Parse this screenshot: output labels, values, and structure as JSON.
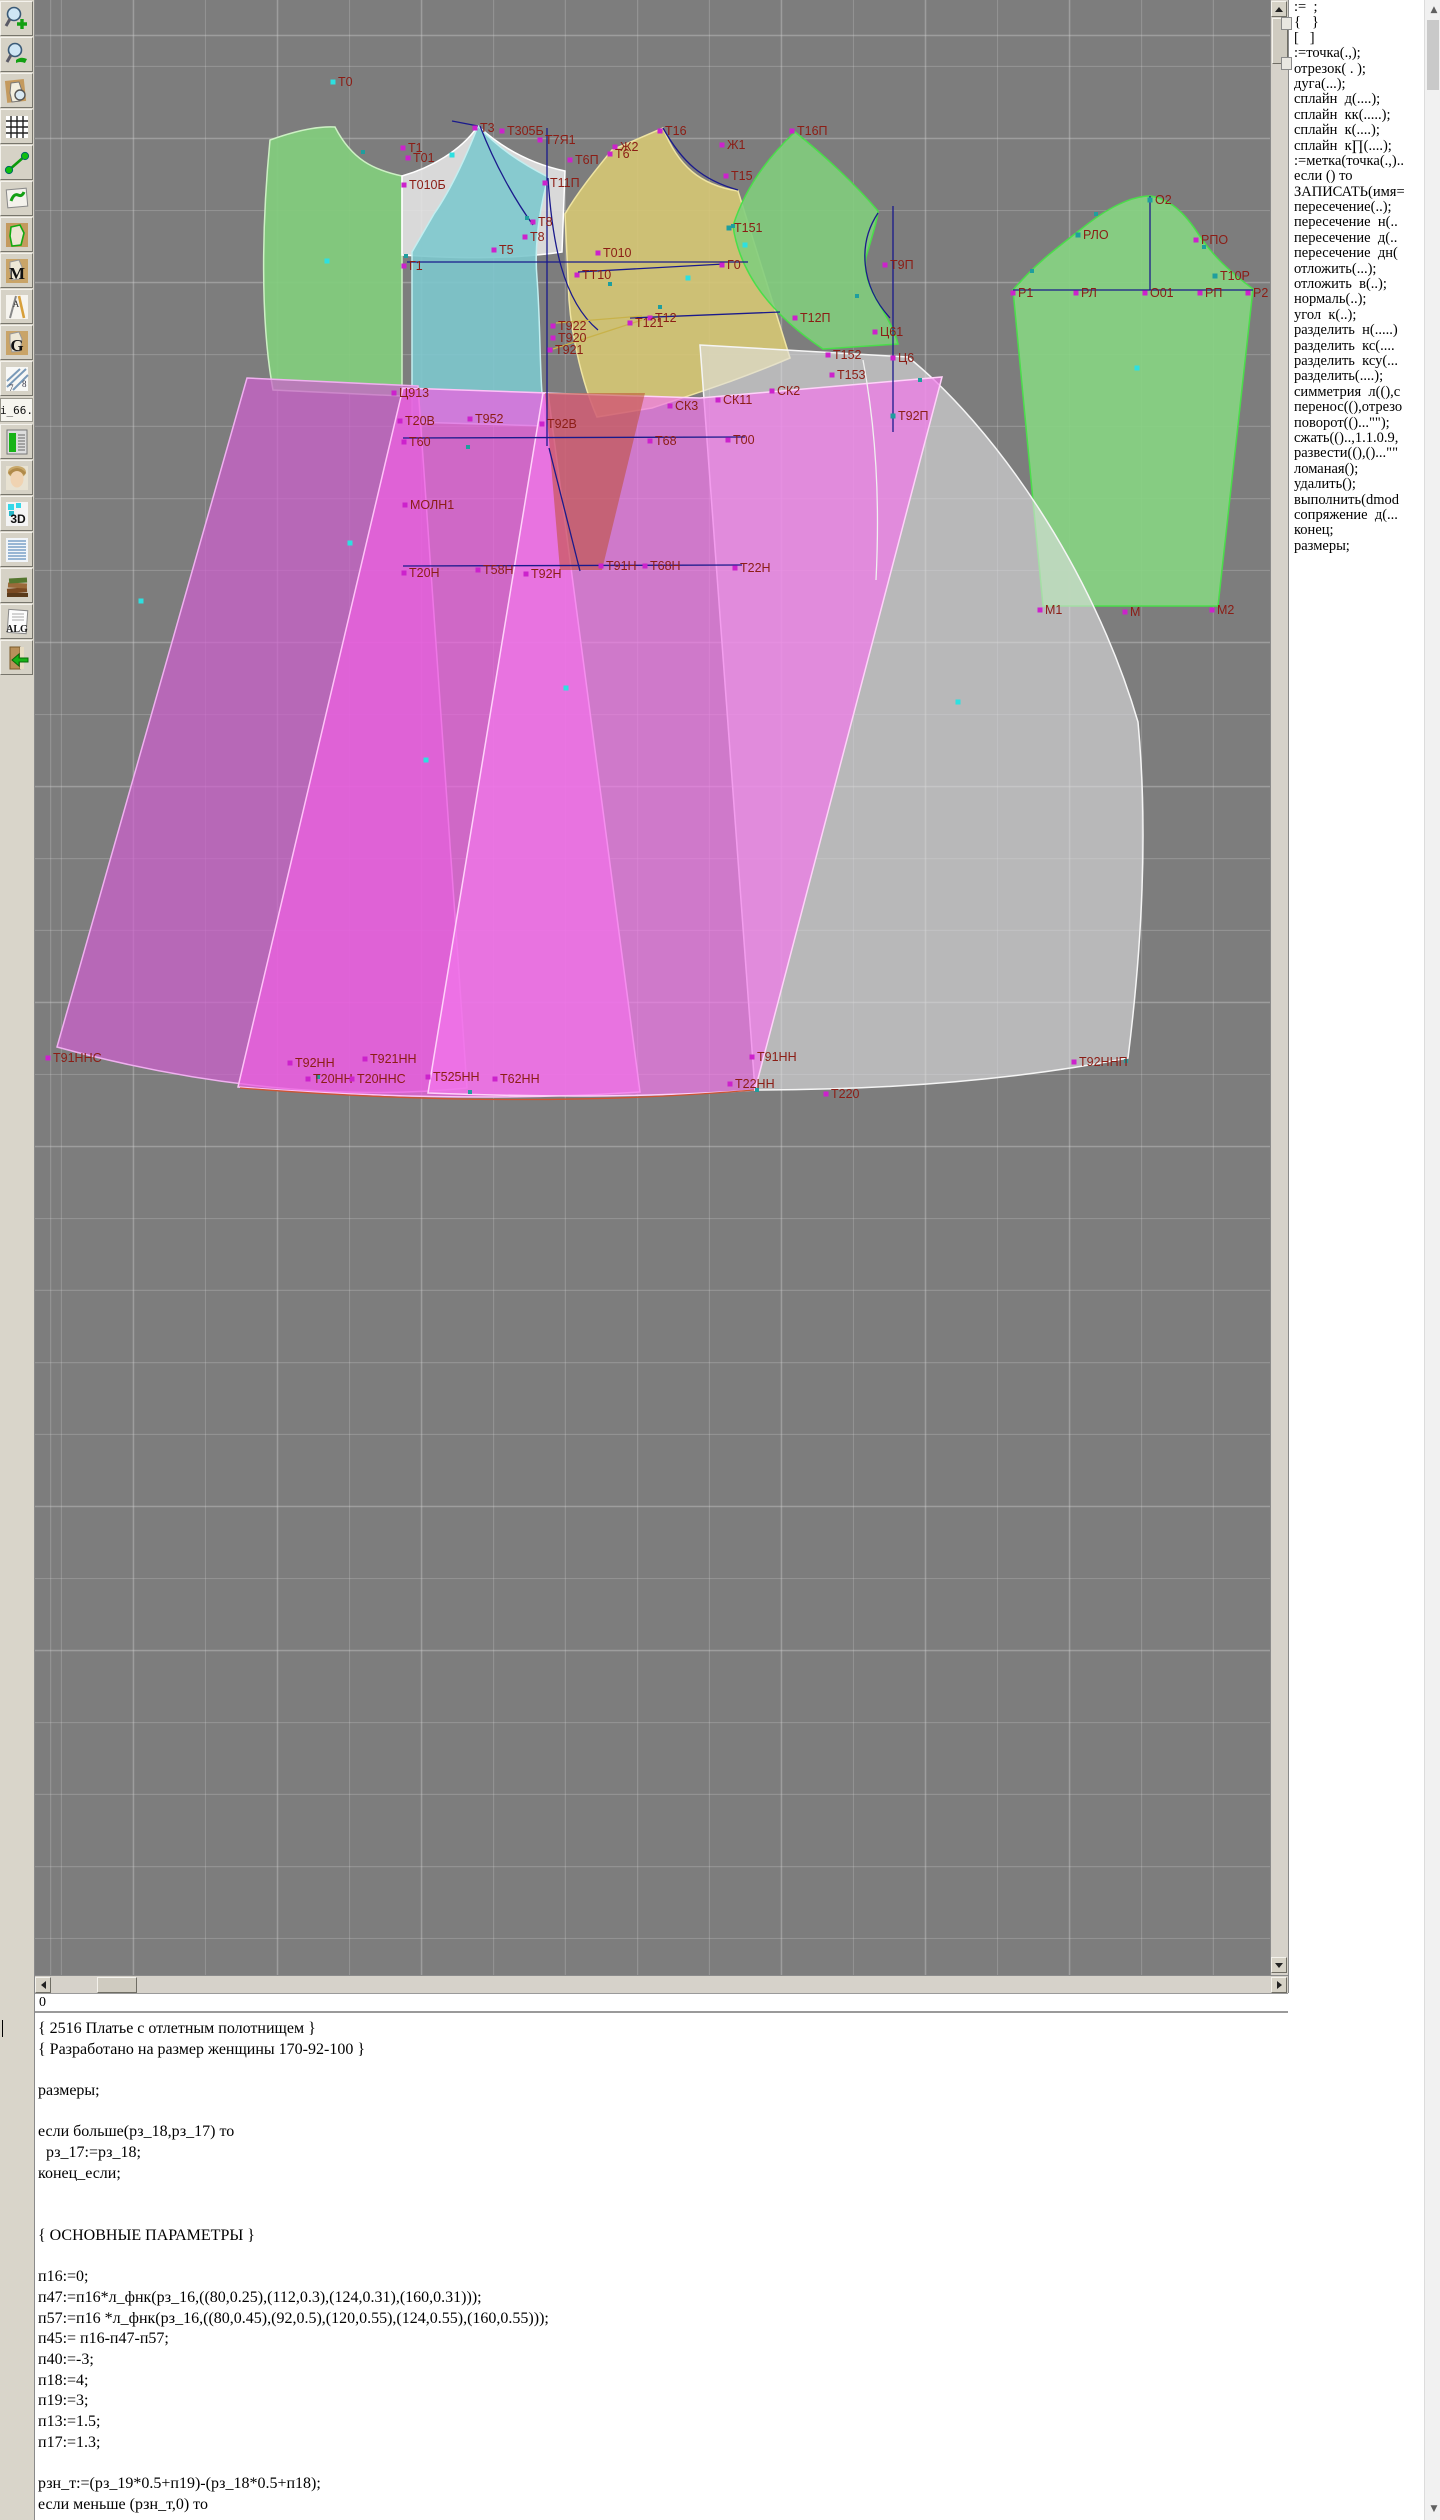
{
  "toolbar": {
    "items": [
      {
        "name": "zoom-in-icon",
        "glyph": "zoom-in"
      },
      {
        "name": "zoom-view-icon",
        "glyph": "zoom-view"
      },
      {
        "name": "piece-preview-icon",
        "glyph": "piece-preview"
      },
      {
        "name": "grid-icon",
        "glyph": "grid"
      },
      {
        "name": "measure-segment-icon",
        "glyph": "segment"
      },
      {
        "name": "sketch-icon",
        "glyph": "sketch"
      },
      {
        "name": "contour-icon",
        "glyph": "contour"
      },
      {
        "name": "pattern-m-icon",
        "glyph": "letter",
        "label": "M"
      },
      {
        "name": "drafting-tools-icon",
        "glyph": "drafting",
        "label": "А"
      },
      {
        "name": "pattern-g-icon",
        "glyph": "letter",
        "label": "G"
      },
      {
        "name": "ruler-icon",
        "glyph": "ruler",
        "label": "8"
      },
      {
        "name": "file-name-label",
        "glyph": "text",
        "label": "i_66."
      },
      {
        "name": "chart-clipboard-icon",
        "glyph": "chart"
      },
      {
        "name": "model-photo-icon",
        "glyph": "face"
      },
      {
        "name": "3d-icon",
        "glyph": "threed",
        "label": "3D"
      },
      {
        "name": "size-table-icon",
        "glyph": "list"
      },
      {
        "name": "books-icon",
        "glyph": "books"
      },
      {
        "name": "alg-document-icon",
        "glyph": "alg",
        "label": "ALG"
      },
      {
        "name": "import-book-icon",
        "glyph": "import"
      }
    ]
  },
  "canvas": {
    "background": "#7d7d7d",
    "grid_color": "#cdcdcd",
    "label_color": "#8b1d15",
    "pieces": [
      {
        "name": "back-bodice",
        "fill": "rgba(130,205,125,0.92)",
        "stroke": "#cdf0c4",
        "path": "M270,140 C295,131 318,126 335,127 C352,160 374,170 402,176 L402,396 L273,390 C260,320 262,222 270,140 Z"
      },
      {
        "name": "front-yoke",
        "fill": "rgba(233,233,233,0.85)",
        "stroke": "#ffffff",
        "path": "M402,176 C430,168 461,151 478,126 C503,149 532,164 565,171 L562,252 C508,260 450,258 402,255 Z"
      },
      {
        "name": "front-bodice-center",
        "fill": "rgba(125,200,205,0.9)",
        "stroke": "#c2eef0",
        "path": "M478,126 C468,152 452,188 434,214 L412,252 L412,422 L545,426 C539,380 541,330 537,278 C534,244 540,208 548,177 C521,163 498,148 478,126 Z"
      },
      {
        "name": "front-bodice-side",
        "fill": "rgba(214,200,116,0.9)",
        "stroke": "#efe4a2",
        "path": "M612,150 L663,128 C678,166 700,185 738,191 L790,358 C741,379 700,392 652,408 L597,417 C583,385 572,340 569,300 L565,214 C579,190 599,166 612,150 Z"
      },
      {
        "name": "side-panel",
        "fill": "rgba(130,205,125,0.9)",
        "stroke": "#4ade4a",
        "path": "M795,132 C765,160 744,191 733,226 C741,281 781,321 823,349 L898,344 C889,310 861,289 866,257 C872,237 877,221 878,211 C855,184 824,155 795,132 Z"
      },
      {
        "name": "sleeve",
        "fill": "rgba(135,210,130,0.92)",
        "stroke": "#4ade4a",
        "path": "M1013,290 C1035,264 1058,247 1080,230 C1108,207 1132,196 1150,196 C1170,199 1185,213 1199,235 C1213,256 1230,272 1253,289 L1218,606 L1043,606 Z"
      },
      {
        "name": "skirt-panel-back",
        "fill": "rgba(223,223,225,0.6)",
        "stroke": "#f5f5f5",
        "path": "M700,345 L908,357 C992,425 1092,565 1138,722 C1149,840 1140,962 1128,1058 C1005,1082 878,1090 755,1090 Z"
      },
      {
        "name": "skirt-panel-left",
        "fill": "rgba(205,95,205,0.72)",
        "stroke": "#f0b0f0",
        "path": "M247,378 L418,386 L467,1088 C330,1102 185,1082 57,1047 Z"
      },
      {
        "name": "skirt-panel-middle",
        "fill": "rgba(238,95,226,0.72)",
        "stroke": "#ffc2f8",
        "path": "M403,388 L548,393 L640,1092 C505,1101 368,1097 238,1087 Z"
      },
      {
        "name": "skirt-panel-front",
        "fill": "rgba(242,120,235,0.7)",
        "stroke": "#ffd2fa",
        "path": "M543,393 L700,398 L942,377 L755,1090 C645,1098 533,1097 428,1093 Z"
      },
      {
        "name": "dart-overlap",
        "fill": "rgba(190,80,50,0.55)",
        "stroke": "none",
        "path": "M545,393 L645,393 L602,570 L560,570 Z"
      }
    ],
    "lines": [
      {
        "name": "bust-line",
        "color": "#1a1a8c",
        "path": "M407,262 L748,262"
      },
      {
        "name": "tt10-line",
        "color": "#1a1a8c",
        "path": "M578,272 L724,264"
      },
      {
        "name": "t12-line",
        "color": "#1a1a8c",
        "path": "M630,318 L780,312"
      },
      {
        "name": "waist-line",
        "color": "#1a1a8c",
        "path": "M403,438 L745,437"
      },
      {
        "name": "hip-line",
        "color": "#1a1a8c",
        "path": "M403,566 L742,565"
      },
      {
        "name": "front-vertical",
        "color": "#1a1a8c",
        "path": "M547,128 L547,446"
      },
      {
        "name": "front-diagonal",
        "color": "#1a1a8c",
        "path": "M549,448 L580,571"
      },
      {
        "name": "side-vertical",
        "color": "#1a1a8c",
        "path": "M893,206 L893,432"
      },
      {
        "name": "sleeve-center",
        "color": "#1a1a8c",
        "path": "M1150,196 L1150,290"
      },
      {
        "name": "sleeve-bicep",
        "color": "#1a1a8c",
        "path": "M1013,290 L1253,290"
      },
      {
        "name": "front-armhole-curve",
        "color": "#1a1a8c",
        "path": "M480,126 C495,165 515,200 533,225"
      },
      {
        "name": "side-seam-curve",
        "color": "#1a1a8c",
        "path": "M548,178 C552,240 562,300 598,330"
      },
      {
        "name": "front-neck-curve",
        "color": "#1a1a8c",
        "path": "M663,128 C682,162 702,180 738,190"
      },
      {
        "name": "side-armhole-curve",
        "color": "#1a1a8c",
        "path": "M878,213 C858,243 860,285 890,318"
      },
      {
        "name": "shoulder-segment",
        "color": "#1a1a8c",
        "path": "M452,121 L478,126"
      },
      {
        "name": "hem-curve",
        "color": "#cc5533",
        "path": "M240,1088 Q520,1110 754,1090"
      },
      {
        "name": "dart-fan-1",
        "color": "#c8b24a",
        "path": "M556,323 L642,316"
      },
      {
        "name": "dart-fan-2",
        "color": "#c8b24a",
        "path": "M553,349 L642,320"
      },
      {
        "name": "panel-seam-white",
        "color": "#f0f0f0",
        "path": "M863,360 C876,430 880,500 876,580"
      }
    ],
    "points": [
      {
        "x": 333,
        "y": 82,
        "label": "Т0",
        "marker": "cyan"
      },
      {
        "x": 475,
        "y": 128,
        "label": "Т3",
        "marker": "magenta"
      },
      {
        "x": 502,
        "y": 131,
        "label": "Т305Б",
        "marker": "magenta"
      },
      {
        "x": 540,
        "y": 140,
        "label": "Т7Я1",
        "marker": "magenta"
      },
      {
        "x": 403,
        "y": 148,
        "label": "Т1",
        "marker": "magenta"
      },
      {
        "x": 408,
        "y": 158,
        "label": "Т01",
        "marker": "magenta"
      },
      {
        "x": 404,
        "y": 185,
        "label": "Т010Б",
        "marker": "magenta"
      },
      {
        "x": 545,
        "y": 183,
        "label": "Т11П",
        "marker": "magenta"
      },
      {
        "x": 570,
        "y": 160,
        "label": "Т6П",
        "marker": "magenta"
      },
      {
        "x": 533,
        "y": 222,
        "label": "Т8",
        "marker": "magenta"
      },
      {
        "x": 525,
        "y": 237,
        "label": "Т8",
        "marker": "magenta"
      },
      {
        "x": 494,
        "y": 250,
        "label": "Т5",
        "marker": "magenta"
      },
      {
        "x": 404,
        "y": 266,
        "label": "Г1",
        "marker": "magenta"
      },
      {
        "x": 615,
        "y": 147,
        "label": "Ж2",
        "marker": "magenta"
      },
      {
        "x": 610,
        "y": 154,
        "label": "Т6",
        "marker": "magenta"
      },
      {
        "x": 660,
        "y": 131,
        "label": "Т16",
        "marker": "magenta"
      },
      {
        "x": 722,
        "y": 145,
        "label": "Ж1",
        "marker": "magenta"
      },
      {
        "x": 726,
        "y": 176,
        "label": "Т15",
        "marker": "magenta"
      },
      {
        "x": 792,
        "y": 131,
        "label": "Т16П",
        "marker": "magenta"
      },
      {
        "x": 729,
        "y": 228,
        "label": "Т151",
        "marker": "teal"
      },
      {
        "x": 598,
        "y": 253,
        "label": "Т010",
        "marker": "magenta"
      },
      {
        "x": 577,
        "y": 275,
        "label": "ТТ10",
        "marker": "magenta"
      },
      {
        "x": 722,
        "y": 265,
        "label": "Г0",
        "marker": "magenta"
      },
      {
        "x": 885,
        "y": 265,
        "label": "Т9П",
        "marker": "magenta"
      },
      {
        "x": 650,
        "y": 318,
        "label": "Т12",
        "marker": "magenta"
      },
      {
        "x": 630,
        "y": 323,
        "label": "Т121",
        "marker": "magenta"
      },
      {
        "x": 553,
        "y": 326,
        "label": "Т922",
        "marker": "magenta"
      },
      {
        "x": 553,
        "y": 338,
        "label": "Т920",
        "marker": "magenta"
      },
      {
        "x": 550,
        "y": 350,
        "label": "Т921",
        "marker": "magenta"
      },
      {
        "x": 795,
        "y": 318,
        "label": "Т12П",
        "marker": "magenta"
      },
      {
        "x": 875,
        "y": 332,
        "label": "Ц61",
        "marker": "magenta"
      },
      {
        "x": 893,
        "y": 358,
        "label": "Ц6",
        "marker": "magenta"
      },
      {
        "x": 828,
        "y": 355,
        "label": "Т152",
        "marker": "magenta"
      },
      {
        "x": 832,
        "y": 375,
        "label": "Т153",
        "marker": "magenta"
      },
      {
        "x": 772,
        "y": 391,
        "label": "СК2",
        "marker": "magenta"
      },
      {
        "x": 718,
        "y": 400,
        "label": "СК11",
        "marker": "magenta"
      },
      {
        "x": 670,
        "y": 406,
        "label": "СК3",
        "marker": "magenta"
      },
      {
        "x": 394,
        "y": 393,
        "label": "Ц913",
        "marker": "magenta"
      },
      {
        "x": 400,
        "y": 421,
        "label": "Т20В",
        "marker": "magenta"
      },
      {
        "x": 470,
        "y": 419,
        "label": "Т952",
        "marker": "magenta"
      },
      {
        "x": 542,
        "y": 424,
        "label": "Т92В",
        "marker": "magenta"
      },
      {
        "x": 404,
        "y": 442,
        "label": "Т60",
        "marker": "magenta"
      },
      {
        "x": 650,
        "y": 441,
        "label": "Т68",
        "marker": "magenta"
      },
      {
        "x": 728,
        "y": 440,
        "label": "Т00",
        "marker": "magenta"
      },
      {
        "x": 405,
        "y": 505,
        "label": "МОЛН1",
        "marker": "magenta"
      },
      {
        "x": 404,
        "y": 573,
        "label": "Т20Н",
        "marker": "magenta"
      },
      {
        "x": 478,
        "y": 570,
        "label": "Т58Н",
        "marker": "magenta"
      },
      {
        "x": 526,
        "y": 574,
        "label": "Т92Н",
        "marker": "magenta"
      },
      {
        "x": 601,
        "y": 566,
        "label": "Т91Н",
        "marker": "magenta"
      },
      {
        "x": 645,
        "y": 566,
        "label": "Т68Н",
        "marker": "magenta"
      },
      {
        "x": 735,
        "y": 568,
        "label": "Т22Н",
        "marker": "magenta"
      },
      {
        "x": 893,
        "y": 416,
        "label": "Т92П",
        "marker": "teal"
      },
      {
        "x": 1150,
        "y": 200,
        "label": "О2",
        "marker": "teal"
      },
      {
        "x": 1078,
        "y": 235,
        "label": "РЛО",
        "marker": "teal"
      },
      {
        "x": 1196,
        "y": 240,
        "label": "РПО",
        "marker": "magenta"
      },
      {
        "x": 1215,
        "y": 276,
        "label": "Т10Р",
        "marker": "teal"
      },
      {
        "x": 1013,
        "y": 293,
        "label": "Р1",
        "marker": "magenta"
      },
      {
        "x": 1076,
        "y": 293,
        "label": "РЛ",
        "marker": "magenta"
      },
      {
        "x": 1145,
        "y": 293,
        "label": "О01",
        "marker": "magenta"
      },
      {
        "x": 1200,
        "y": 293,
        "label": "РП",
        "marker": "magenta"
      },
      {
        "x": 1248,
        "y": 293,
        "label": "Р2",
        "marker": "magenta"
      },
      {
        "x": 1040,
        "y": 610,
        "label": "М1",
        "marker": "magenta"
      },
      {
        "x": 1125,
        "y": 612,
        "label": "М",
        "marker": "magenta"
      },
      {
        "x": 1212,
        "y": 610,
        "label": "М2",
        "marker": "magenta"
      },
      {
        "x": 48,
        "y": 1058,
        "label": "Т91ННС",
        "marker": "magenta"
      },
      {
        "x": 290,
        "y": 1063,
        "label": "Т92НН",
        "marker": "magenta"
      },
      {
        "x": 365,
        "y": 1059,
        "label": "Т921НН",
        "marker": "magenta"
      },
      {
        "x": 308,
        "y": 1079,
        "label": "Т20НН",
        "marker": "magenta"
      },
      {
        "x": 352,
        "y": 1079,
        "label": "Т20ННС",
        "marker": "magenta"
      },
      {
        "x": 428,
        "y": 1077,
        "label": "Т525НН",
        "marker": "magenta"
      },
      {
        "x": 495,
        "y": 1079,
        "label": "Т62НН",
        "marker": "magenta"
      },
      {
        "x": 752,
        "y": 1057,
        "label": "Т91НН",
        "marker": "magenta"
      },
      {
        "x": 730,
        "y": 1084,
        "label": "Т22НН",
        "marker": "magenta"
      },
      {
        "x": 826,
        "y": 1094,
        "label": "Т220",
        "marker": "magenta"
      },
      {
        "x": 1074,
        "y": 1062,
        "label": "Т92ННП",
        "marker": "magenta"
      }
    ],
    "dots": [
      {
        "x": 327,
        "y": 261
      },
      {
        "x": 452,
        "y": 155
      },
      {
        "x": 688,
        "y": 278
      },
      {
        "x": 745,
        "y": 245
      },
      {
        "x": 1137,
        "y": 368
      },
      {
        "x": 141,
        "y": 601
      },
      {
        "x": 350,
        "y": 543
      },
      {
        "x": 566,
        "y": 688
      },
      {
        "x": 426,
        "y": 760
      },
      {
        "x": 958,
        "y": 702
      }
    ],
    "notches": [
      {
        "x": 363,
        "y": 152
      },
      {
        "x": 406,
        "y": 256
      },
      {
        "x": 527,
        "y": 218
      },
      {
        "x": 610,
        "y": 284
      },
      {
        "x": 660,
        "y": 307
      },
      {
        "x": 733,
        "y": 226
      },
      {
        "x": 857,
        "y": 296
      },
      {
        "x": 1032,
        "y": 271
      },
      {
        "x": 1096,
        "y": 214
      },
      {
        "x": 1204,
        "y": 247
      },
      {
        "x": 470,
        "y": 1092
      },
      {
        "x": 757,
        "y": 1090
      },
      {
        "x": 1126,
        "y": 1061
      },
      {
        "x": 318,
        "y": 1077
      },
      {
        "x": 468,
        "y": 447
      },
      {
        "x": 920,
        "y": 380
      }
    ]
  },
  "status": {
    "left_value": "0",
    "buttons": [
      {
        "label": "Рз"
      },
      {
        "label": "Мл"
      }
    ]
  },
  "commands_panel": {
    "lines": [
      ":=  ;",
      "{   }",
      "[   ]",
      ":=точка(.,);",
      "отрезок( . );",
      "дуга(...);",
      "сплайн  д(....);",
      "сплайн  кк(.....);",
      "сплайн  к(....);",
      "сплайн  к∏(....);",
      ":=метка(точка(.,)..",
      "если () то",
      "ЗАПИСАТЬ(имя=",
      "пересечение(..);",
      "пересечение  н(..",
      "пересечение  д(..",
      "пересечение  дн(",
      "отложить(...);",
      "отложить  в(..);",
      "нормаль(..);",
      "угол  к(..);",
      "разделить  н(.....)",
      "разделить  кс(....",
      "разделить  ксу(...",
      "разделить(....);",
      "симметрия  л((),с",
      "перенос((),отрезо",
      "поворот(()...\"\");",
      "сжать(()..,1.1.0.9,",
      "развести((),()...\"\"",
      "ломаная();",
      "удалить();",
      "выполнить(dmod",
      "сопряжение  д(...",
      "конец;",
      "размеры;"
    ]
  },
  "code_editor": {
    "lines": [
      "{ 2516 Платье с отлетным полотнищем }",
      "{ Разработано на размер женщины 170-92-100 }",
      "",
      "размеры;",
      "",
      "если больше(рз_18,рз_17) то",
      "  рз_17:=рз_18;",
      "конец_если;",
      "",
      "",
      "{ ОСНОВНЫЕ ПАРАМЕТРЫ }",
      "",
      "п16:=0;",
      "п47:=п16*л_фнк(рз_16,((80,0.25),(112,0.3),(124,0.31),(160,0.31)));",
      "п57:=п16 *л_фнк(рз_16,((80,0.45),(92,0.5),(120,0.55),(124,0.55),(160,0.55)));",
      "п45:= п16-п47-п57;",
      "п40:=-3;",
      "п18:=4;",
      "п19:=3;",
      "п13:=1.5;",
      "п17:=1.3;",
      "",
      "рзн_т:=(рз_19*0.5+п19)-(рз_18*0.5+п18);",
      "если меньше (рзн_т,0) то"
    ]
  }
}
